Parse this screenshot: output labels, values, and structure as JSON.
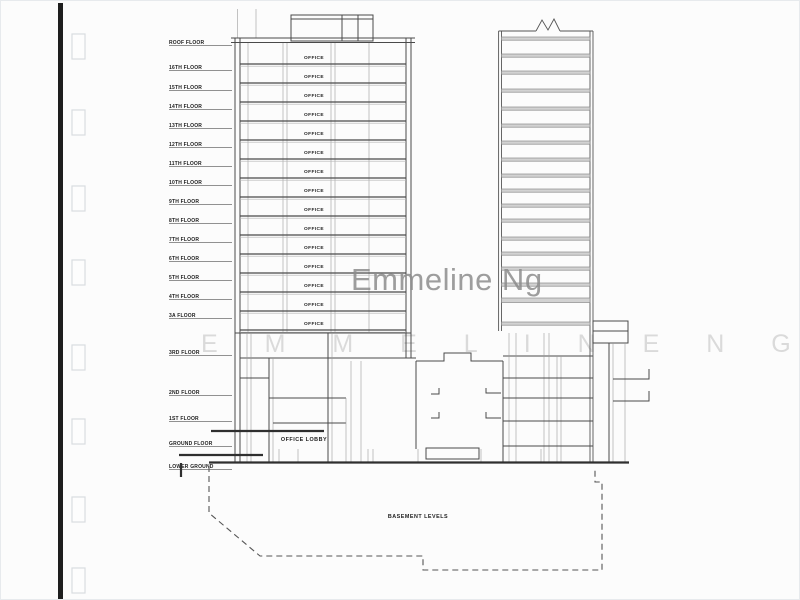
{
  "document": {
    "type_label": "building-section-drawing",
    "floor_labels": [
      "ROOF FLOOR",
      "16TH FLOOR",
      "15TH FLOOR",
      "14TH FLOOR",
      "13TH FLOOR",
      "12TH FLOOR",
      "11TH FLOOR",
      "10TH FLOOR",
      "9TH FLOOR",
      "8TH FLOOR",
      "7TH FLOOR",
      "6TH FLOOR",
      "5TH FLOOR",
      "4TH FLOOR",
      "3A FLOOR",
      "3RD FLOOR",
      "2ND FLOOR",
      "1ST FLOOR",
      "GROUND FLOOR",
      "LOWER GROUND"
    ],
    "tower_left": {
      "office_labels": [
        "OFFICE",
        "OFFICE",
        "OFFICE",
        "OFFICE",
        "OFFICE",
        "OFFICE",
        "OFFICE",
        "OFFICE",
        "OFFICE",
        "OFFICE",
        "OFFICE",
        "OFFICE",
        "OFFICE",
        "OFFICE",
        "OFFICE"
      ]
    },
    "podium": {
      "lobby_label": "OFFICE LOBBY"
    },
    "basement": {
      "label": "BASEMENT LEVELS"
    },
    "punch_hole_count": 8
  },
  "watermark": {
    "primary": "Emmeline Ng",
    "secondary": "E M M E L I N E   N G"
  },
  "colors": {
    "paper": "#fcfcfc",
    "ink": "#2f2f2f",
    "slab_band": "#d2d2d2",
    "watermark_primary": "#8c8c8c",
    "watermark_secondary": "#dadada",
    "scan_bar": "#1e1e1e"
  }
}
